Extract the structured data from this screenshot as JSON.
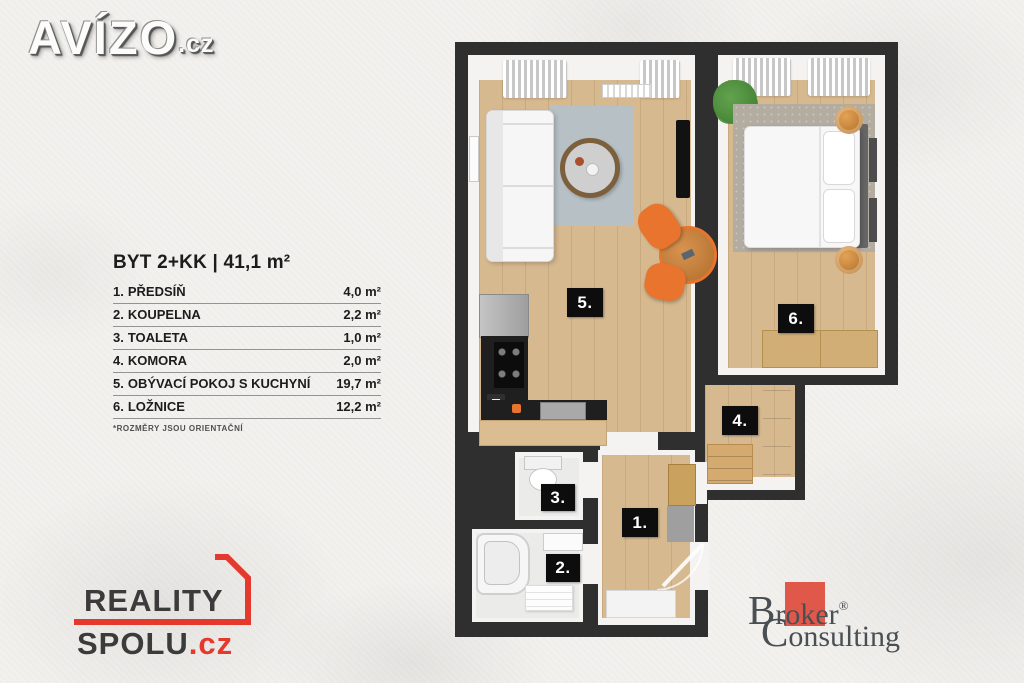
{
  "branding": {
    "avizo": {
      "name": "AVÍZO",
      "tld": ".cz"
    },
    "reality_spolu": {
      "line1": "REALITY",
      "line2": "SPOLU",
      "tld": ".cz"
    },
    "broker": {
      "word1_big": "B",
      "word1_small": "roker",
      "reg": "®",
      "word2_big": "C",
      "word2_small": "onsulting"
    }
  },
  "legend": {
    "title": "BYT 2+KK | 41,1 m²",
    "items": [
      {
        "num": "1.",
        "name": "PŘEDSÍŇ",
        "area": "4,0 m²"
      },
      {
        "num": "2.",
        "name": "KOUPELNA",
        "area": "2,2 m²"
      },
      {
        "num": "3.",
        "name": "TOALETA",
        "area": "1,0 m²"
      },
      {
        "num": "4.",
        "name": "KOMORA",
        "area": "2,0 m²"
      },
      {
        "num": "5.",
        "name": "OBÝVACÍ POKOJ S KUCHYNÍ",
        "area": "19,7 m²"
      },
      {
        "num": "6.",
        "name": "LOŽNICE",
        "area": "12,2 m²"
      }
    ],
    "footnote": "*ROZMĚRY JSOU ORIENTAČNÍ"
  },
  "floorplan": {
    "labels": {
      "hall": "1.",
      "bathroom": "2.",
      "toilet": "3.",
      "storage": "4.",
      "living": "5.",
      "bedroom": "6."
    }
  },
  "colors": {
    "wall": "#2f2f2f",
    "wood_floor": "#d7b990",
    "accent_orange": "#e8742e",
    "reality_red": "#e6392e",
    "broker_red": "#e0584a"
  }
}
